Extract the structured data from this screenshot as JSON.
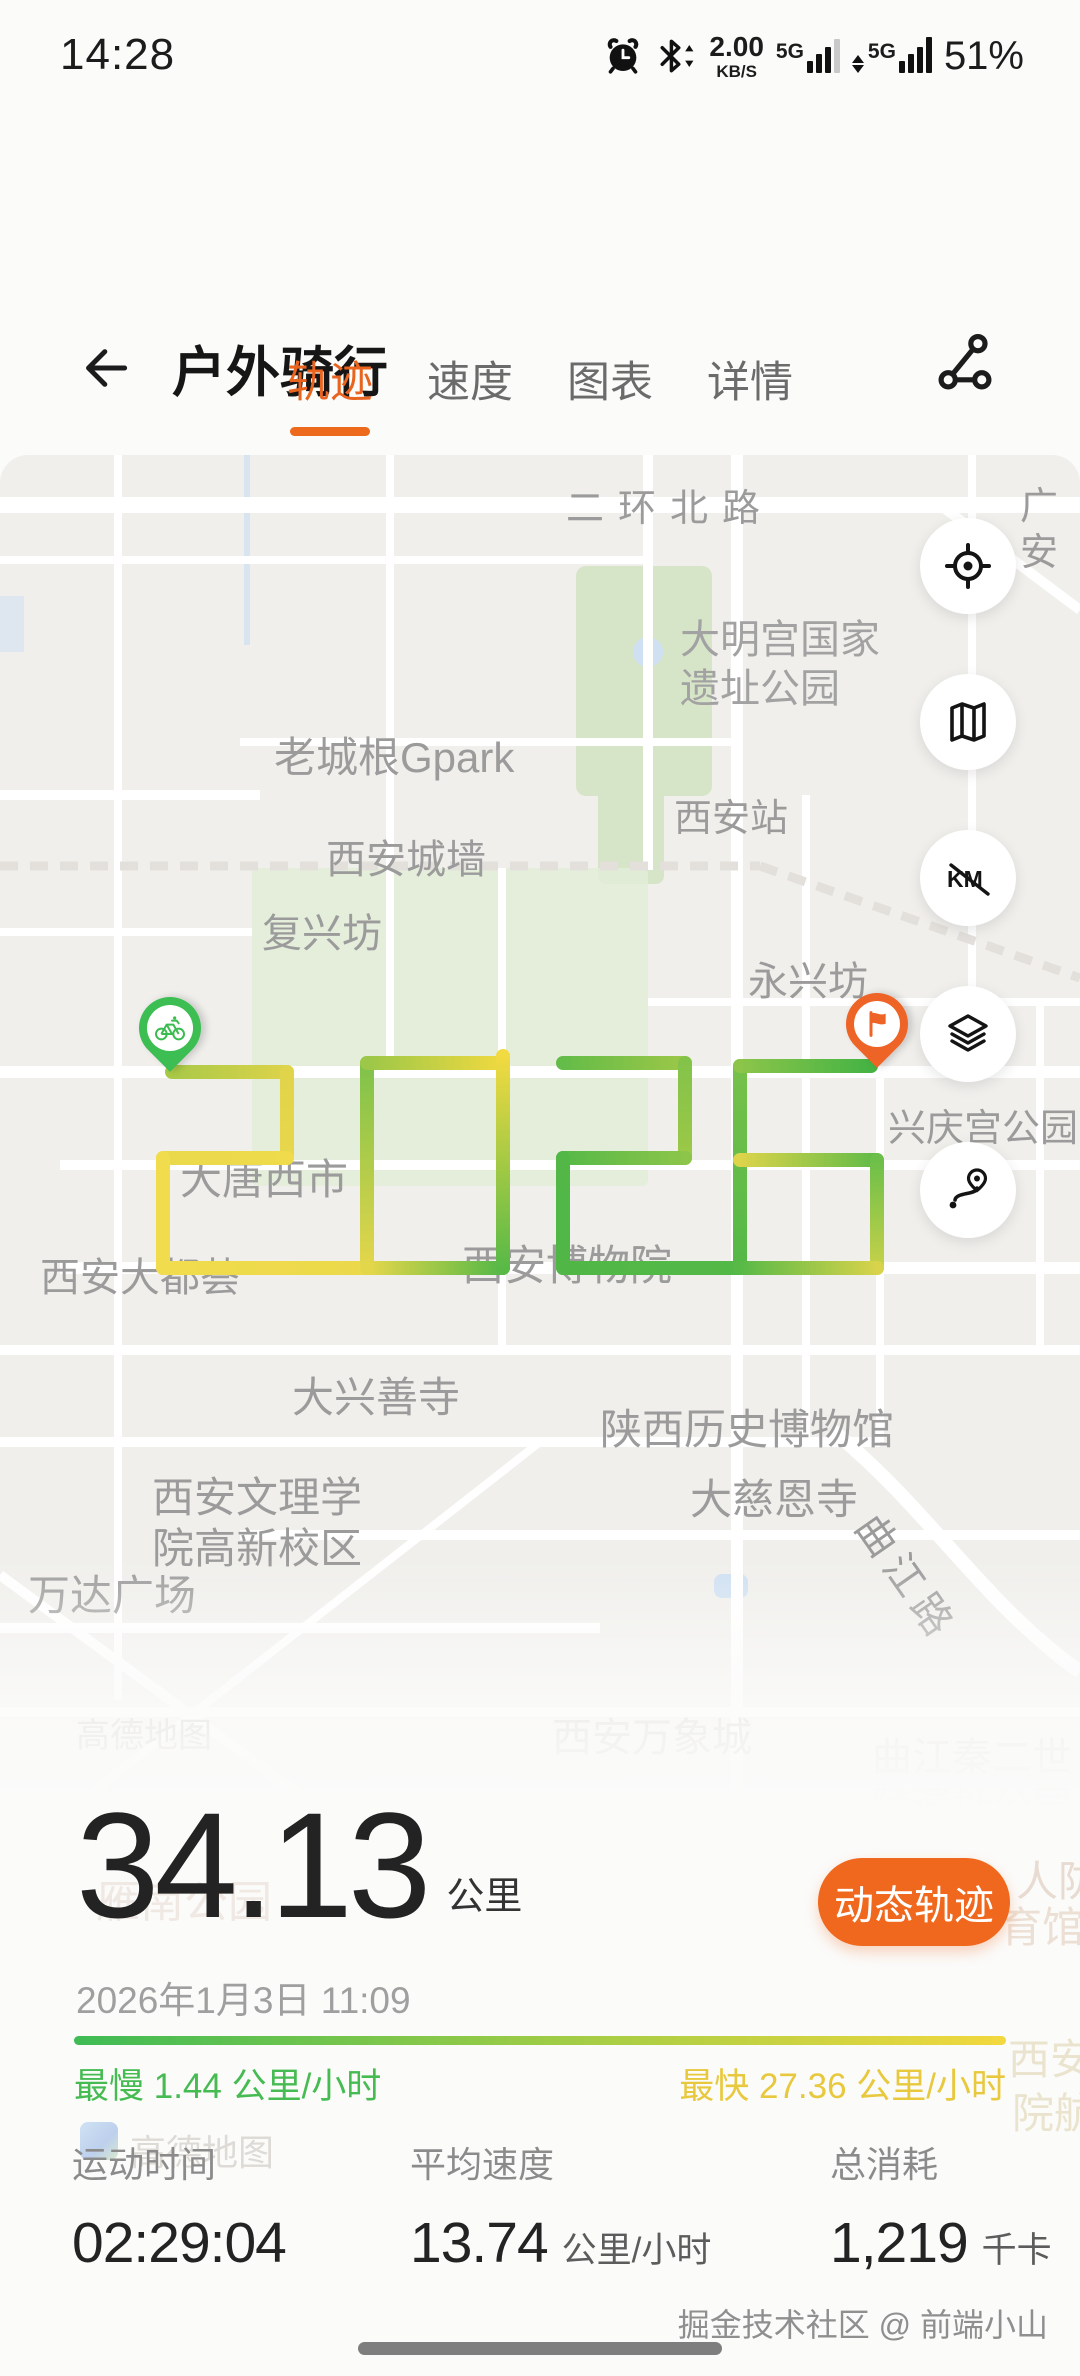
{
  "status_bar": {
    "time": "14:28",
    "net_speed": "2.00",
    "net_unit": "KB/S",
    "sim1": "5G",
    "sim2": "5G",
    "battery": "51%"
  },
  "header": {
    "title": "户外骑行"
  },
  "tabs": [
    {
      "label": "轨迹",
      "active": true
    },
    {
      "label": "速度",
      "active": false
    },
    {
      "label": "图表",
      "active": false
    },
    {
      "label": "详情",
      "active": false
    }
  ],
  "map": {
    "labels": [
      {
        "text": "二环北路",
        "x": 566,
        "y": 486,
        "size": 38,
        "ls": 14
      },
      {
        "text": "广安",
        "x": 1020,
        "y": 484,
        "size": 38
      },
      {
        "text": "大明宫国家\n遗址公园",
        "x": 680,
        "y": 616,
        "size": 40,
        "color": "#a2a2a2"
      },
      {
        "text": "老城根Gpark",
        "x": 274,
        "y": 732,
        "size": 42
      },
      {
        "text": "西安站",
        "x": 674,
        "y": 796,
        "size": 38
      },
      {
        "text": "西安城墙",
        "x": 326,
        "y": 836,
        "size": 40
      },
      {
        "text": "复兴坊",
        "x": 262,
        "y": 910,
        "size": 40
      },
      {
        "text": "永兴坊",
        "x": 748,
        "y": 958,
        "size": 40
      },
      {
        "text": "兴庆宫公园",
        "x": 888,
        "y": 1106,
        "size": 38
      },
      {
        "text": "大唐西市",
        "x": 180,
        "y": 1154,
        "size": 42
      },
      {
        "text": "西安大都荟",
        "x": 40,
        "y": 1254,
        "size": 40
      },
      {
        "text": "西安博物院",
        "x": 462,
        "y": 1240,
        "size": 42
      },
      {
        "text": "大兴善寺",
        "x": 292,
        "y": 1372,
        "size": 42
      },
      {
        "text": "陕西历史博物馆",
        "x": 600,
        "y": 1404,
        "size": 42
      },
      {
        "text": "大慈恩寺",
        "x": 690,
        "y": 1474,
        "size": 42
      },
      {
        "text": "西安文理学\n院高新校区",
        "x": 152,
        "y": 1472,
        "size": 42
      },
      {
        "text": "万达广场",
        "x": 28,
        "y": 1570,
        "size": 42
      },
      {
        "text": "曲江路",
        "x": 884,
        "y": 1506,
        "size": 40,
        "rotate": 55,
        "ls": 8
      },
      {
        "text": "高德地图",
        "x": 76,
        "y": 1716,
        "size": 34,
        "color": "#a8a5a1"
      },
      {
        "text": "西安万象城",
        "x": 552,
        "y": 1714,
        "size": 40,
        "color": "#b5b2ae"
      },
      {
        "text": "曲江秦二世\n陵遗址公园",
        "x": 872,
        "y": 1734,
        "size": 40,
        "color": "#c9c6c2"
      }
    ],
    "controls": [
      {
        "name": "locate"
      },
      {
        "name": "map-mode"
      },
      {
        "name": "km-toggle"
      },
      {
        "name": "layers"
      },
      {
        "name": "route-overview"
      }
    ],
    "route_segments": [
      [
        172,
        1072,
        287,
        1072,
        "#a9c947",
        "#ddd34a"
      ],
      [
        287,
        1072,
        287,
        1158,
        "#e0d44a",
        "#e8d74b"
      ],
      [
        287,
        1158,
        163,
        1158,
        "#efdb4c",
        "#eada4b"
      ],
      [
        163,
        1158,
        163,
        1268,
        "#f0dc4c",
        "#f0dc4c"
      ],
      [
        163,
        1268,
        367,
        1268,
        "#f0dc4c",
        "#ecd94b"
      ],
      [
        367,
        1268,
        503,
        1268,
        "#e6d74a",
        "#54b847"
      ],
      [
        367,
        1268,
        367,
        1063,
        "#e4d64b",
        "#7ec24a"
      ],
      [
        367,
        1063,
        503,
        1063,
        "#9cc748",
        "#f0d940"
      ],
      [
        503,
        1056,
        503,
        1268,
        "#f2da41",
        "#58b947"
      ],
      [
        563,
        1063,
        685,
        1063,
        "#64bc48",
        "#9cc748"
      ],
      [
        685,
        1063,
        685,
        1158,
        "#84c34a",
        "#9cc847"
      ],
      [
        685,
        1158,
        563,
        1158,
        "#8cc54a",
        "#56b947"
      ],
      [
        563,
        1158,
        563,
        1268,
        "#52b746",
        "#50b746"
      ],
      [
        563,
        1268,
        740,
        1268,
        "#50b746",
        "#54b847"
      ],
      [
        740,
        1268,
        740,
        1066,
        "#54b847",
        "#76c14a"
      ],
      [
        740,
        1066,
        871,
        1066,
        "#8cc54a",
        "#44b344"
      ],
      [
        740,
        1160,
        877,
        1160,
        "#dcd44a",
        "#60bb48"
      ],
      [
        877,
        1160,
        877,
        1268,
        "#6cbf49",
        "#c6d149"
      ],
      [
        740,
        1268,
        877,
        1268,
        "#58b947",
        "#d8d34b"
      ]
    ]
  },
  "overlay_labels": [
    {
      "text": "雁南公园",
      "x": 96,
      "y": 1866,
      "size": 44,
      "color": "#f0e8e3"
    },
    {
      "text": "人防",
      "x": 1016,
      "y": 1848,
      "size": 42,
      "color": "#e8dcd2"
    },
    {
      "text": "育馆",
      "x": 1000,
      "y": 1894,
      "size": 42,
      "color": "#ecdfd4"
    },
    {
      "text": "西安",
      "x": 1008,
      "y": 2026,
      "size": 42,
      "color": "#eae4cf"
    },
    {
      "text": "院航",
      "x": 1012,
      "y": 2080,
      "size": 42,
      "color": "#eae4cf"
    },
    {
      "text": "高德地图",
      "x": 130,
      "y": 2124,
      "size": 36,
      "color": "#dedbd7"
    }
  ],
  "summary": {
    "distance": "34.13",
    "distance_unit": "公里",
    "datetime": "2026年1月3日 11:09",
    "action_button": "动态轨迹",
    "slowest": "最慢 1.44 公里/小时",
    "fastest": "最快 27.36 公里/小时"
  },
  "stats": [
    {
      "label": "运动时间",
      "value": "02:29:04",
      "unit": ""
    },
    {
      "label": "平均速度",
      "value": "13.74",
      "unit": "公里/小时"
    },
    {
      "label": "总消耗",
      "value": "1,219",
      "unit": "千卡"
    }
  ],
  "footer": {
    "watermark": "掘金技术社区 @ 前端小山"
  },
  "colors": {
    "accent": "#ED6A1C",
    "action_button": "#F0681D",
    "slow_green": "#46BB52",
    "fast_yellow": "#E8C83C",
    "start_pin": "#3CBE52",
    "end_pin": "#EE6426"
  }
}
